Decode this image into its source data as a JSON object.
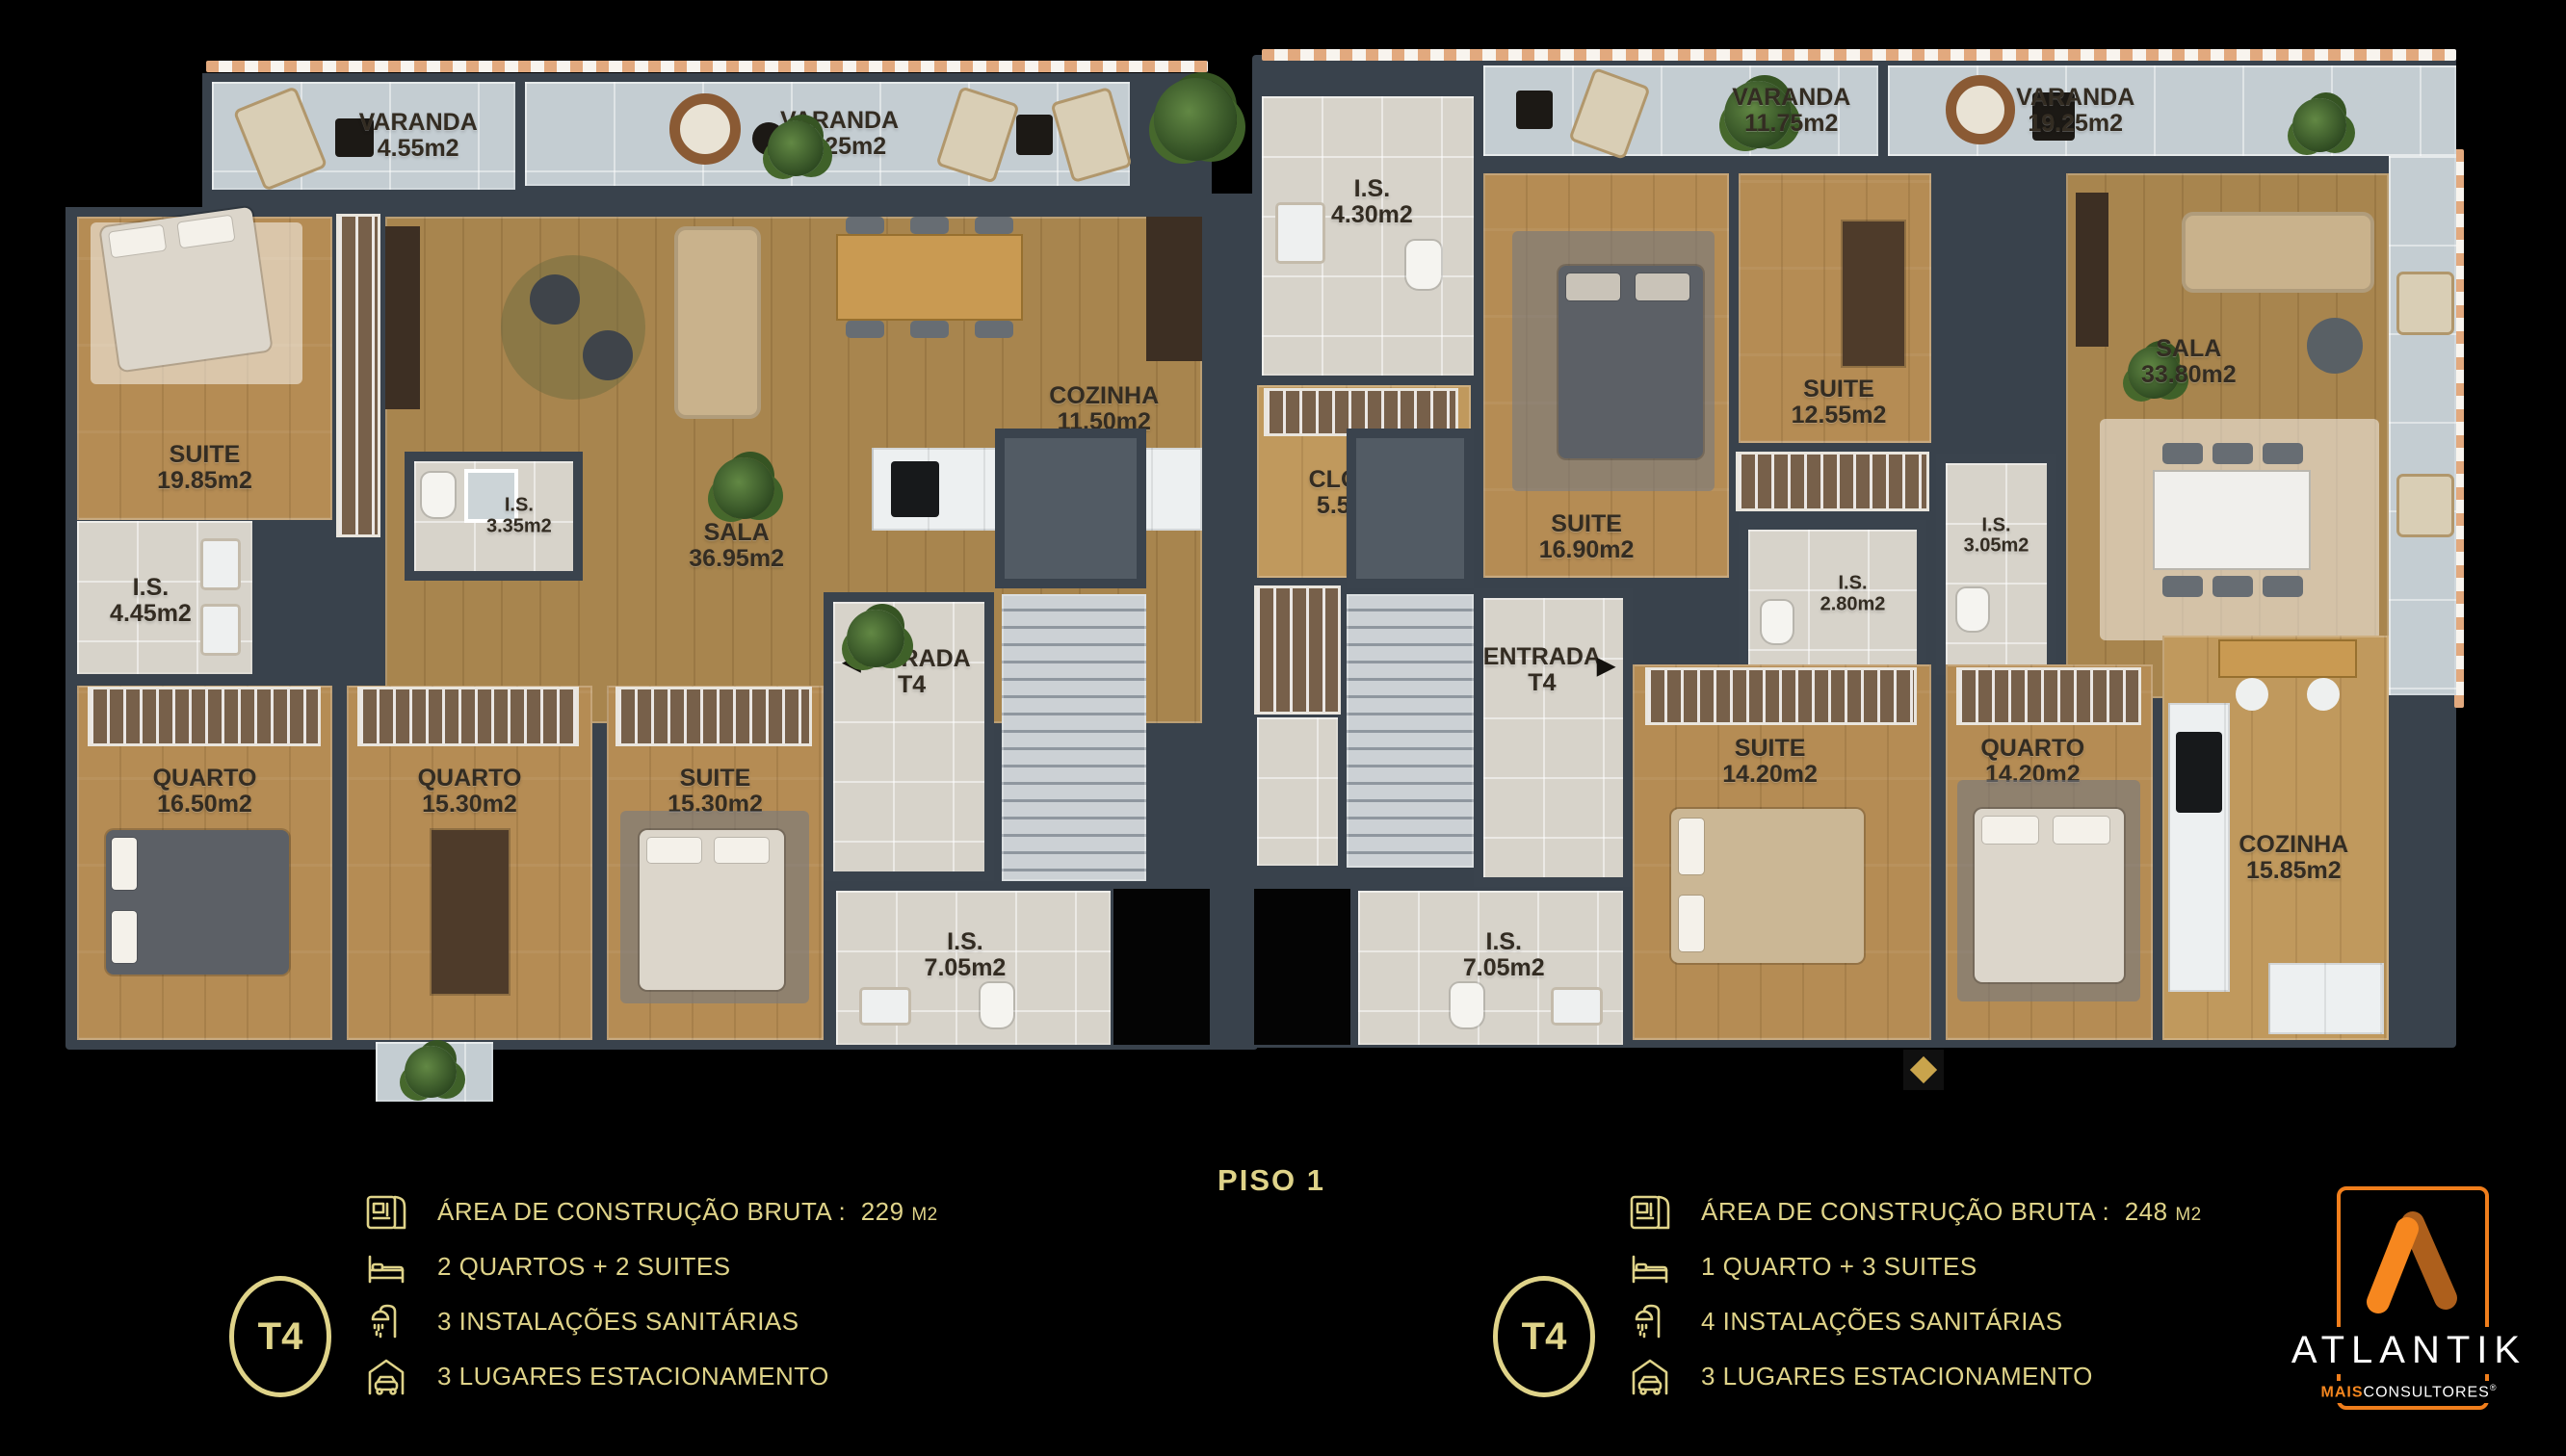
{
  "colors": {
    "background": "#000000",
    "legend_gold": "#DFD389",
    "wall": "#39424C",
    "logo_orange": "#F6871F",
    "logo_dark_orange": "#AD5F1C"
  },
  "units": {
    "left": {
      "varandas": [
        {
          "name": "VARANDA",
          "area": "4.55m2"
        },
        {
          "name": "VARANDA",
          "area": "11.25m2"
        }
      ],
      "rooms": [
        {
          "name": "SUITE",
          "area": "19.85m2"
        },
        {
          "name": "I.S.",
          "area": "4.45m2"
        },
        {
          "name": "I.S.",
          "area": "3.35m2"
        },
        {
          "name": "SALA",
          "area": "36.95m2"
        },
        {
          "name": "COZINHA",
          "area": "11.50m2"
        },
        {
          "name": "QUARTO",
          "area": "16.50m2"
        },
        {
          "name": "QUARTO",
          "area": "15.30m2"
        },
        {
          "name": "SUITE",
          "area": "15.30m2"
        },
        {
          "name": "I.S.",
          "area": "7.05m2"
        }
      ],
      "entrance": {
        "title": "ENTRADA",
        "unit": "T4",
        "arrow": "◀"
      }
    },
    "right": {
      "varandas": [
        {
          "name": "VARANDA",
          "area": "11.75m2"
        },
        {
          "name": "VARANDA",
          "area": "19.25m2"
        }
      ],
      "rooms": [
        {
          "name": "I.S.",
          "area": "4.30m2"
        },
        {
          "name": "CLOSET",
          "area": "5.50m2"
        },
        {
          "name": "SUITE",
          "area": "16.90m2"
        },
        {
          "name": "SUITE",
          "area": "12.55m2"
        },
        {
          "name": "I.S.",
          "area": "2.80m2"
        },
        {
          "name": "I.S.",
          "area": "3.05m2"
        },
        {
          "name": "SALA",
          "area": "33.80m2"
        },
        {
          "name": "SUITE",
          "area": "14.20m2"
        },
        {
          "name": "QUARTO",
          "area": "14.20m2"
        },
        {
          "name": "COZINHA",
          "area": "15.85m2"
        },
        {
          "name": "I.S.",
          "area": "7.05m2"
        }
      ],
      "entrance": {
        "title": "ENTRADA",
        "unit": "T4",
        "arrow": "▶"
      }
    }
  },
  "legend": {
    "floor_label": "PISO 1",
    "left": {
      "badge": "T4",
      "rows": [
        {
          "label": "ÁREA DE CONSTRUÇÃO BRUTA :",
          "value": "229",
          "unit": "M2"
        },
        {
          "label": "2 QUARTOS + 2 SUITES"
        },
        {
          "label": "3 INSTALAÇÕES SANITÁRIAS"
        },
        {
          "label": "3 LUGARES ESTACIONAMENTO"
        }
      ]
    },
    "right": {
      "badge": "T4",
      "rows": [
        {
          "label": "ÁREA DE CONSTRUÇÃO BRUTA :",
          "value": "248",
          "unit": "M2"
        },
        {
          "label": "1 QUARTO + 3 SUITES"
        },
        {
          "label": "4 INSTALAÇÕES SANITÁRIAS"
        },
        {
          "label": "3 LUGARES ESTACIONAMENTO"
        }
      ]
    }
  },
  "brand": {
    "name": "ATLANTIK",
    "sub_bold": "MAIS",
    "sub": "CONSULTORES",
    "reg": "®"
  }
}
